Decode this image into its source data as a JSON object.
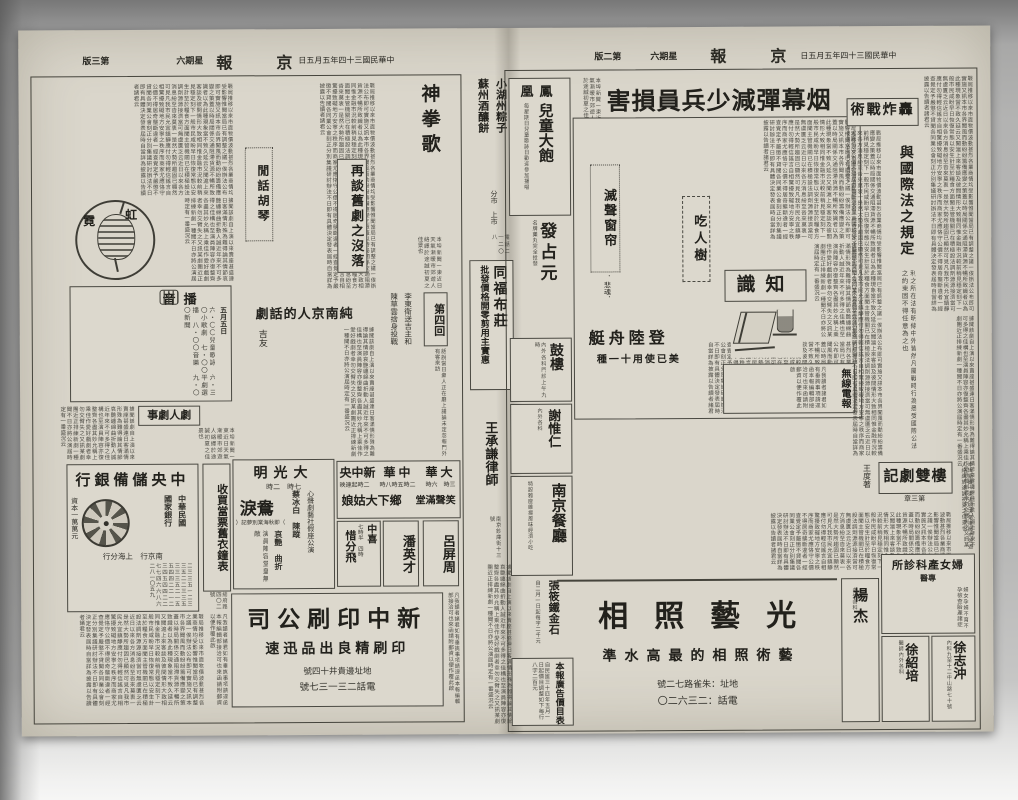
{
  "masthead": {
    "title": "京　報",
    "date": "中華民國三十四年五月五日",
    "weekday": "星期六",
    "edition_right": "第二版",
    "edition_left": "第三版"
  },
  "page_right": {
    "lead_headline": "烟幕彈減少兵員損害",
    "articles": {
      "bombing": {
        "title": "轟炸戰術",
        "subtitle": "與國際法之規定"
      },
      "silencer": {
        "title": "滅聲窗帘",
        "byline": "．悲魂．"
      },
      "tree": {
        "title": "吃人樹"
      },
      "knowledge": {
        "title": "知識"
      },
      "landing": {
        "title": "登陸舟艇",
        "subtitle": "美已使用十一種"
      },
      "wireless": {
        "title": "無線電報"
      },
      "serial": {
        "title": "瓊樓雙劇記",
        "author": "王度著",
        "chapter": "第三章"
      }
    },
    "ads": {
      "phoenix": {
        "title": "鳳凰",
        "big": "兒童大飽",
        "note": "每星期日兒童歌詠日歡迎參加播唱"
      },
      "fazhanyuan": {
        "title": "發占元",
        "note": "名牌藥丸完全批發"
      },
      "gulou": {
        "title": "鼓樓",
        "note": "內外各科門診上午九時"
      },
      "xieweiren": {
        "title": "謝惟仁",
        "note": "內外各科"
      },
      "lawyer": {
        "title": "王承謙律師",
        "note": "南京鈔庫街十三號"
      },
      "restaurant": {
        "title": "南京餐廳",
        "note": "特設雅座維揚風味經濟小吃"
      },
      "seal": {
        "title": "張筱鐵金石",
        "note": "自二月一日起每字二千元"
      },
      "pricelist": {
        "title": "本報廣告價目表",
        "note": "自民國三十四年五月一日起價目調整如下每行八字二百元"
      },
      "photo": {
        "title": "光藝照相",
        "subtitle": "藝術照相的最高水準",
        "address": "地址：朱雀路七二號",
        "phone": "電話：二三六二〇"
      },
      "yangjie": {
        "title": "楊杰",
        "note": "內外各科"
      },
      "clinic": {
        "title": "婦女產科診所",
        "sub": "專醫",
        "note": "婦女孕婦不育不孕檢查胎產諸症"
      },
      "xuzhichong": {
        "title": "徐志沖",
        "note": "內科九至十二中山路七十號"
      },
      "xushaopei": {
        "title": "徐紹培",
        "note": "醫師內外各科"
      }
    }
  },
  "gutter_ads": {
    "zongzi": {
      "line1": "小湖州粽子",
      "line2": "蘇州酒釀餅",
      "note": "分市　上市",
      "phone": "電話二一二〇八"
    },
    "tongfu": {
      "title": "同福布莊",
      "lines": "批發價格開零剪用主實惠"
    }
  },
  "page_left": {
    "articles": {
      "huqin": {
        "title": "閒話胡琴"
      },
      "opera": {
        "title": "再談舊劇之沒落"
      },
      "songfist": {
        "title": "神拳歌"
      },
      "drama": {
        "title": "純南京人的話劇",
        "byline": "吉友"
      },
      "gossip": {
        "title": "劇人劇事"
      },
      "serial": {
        "chapter": "第四回",
        "c1": "李東衛送吉主和",
        "c2": "陳草雲捨身投戰"
      },
      "rainbow": {
        "char1": "虹",
        "char2": "霓"
      },
      "broadcast": {
        "title": "播音",
        "date": "五月五日",
        "items_text": "六・〇〇兒童歌詠　六・三〇小歌劇　七・〇〇平劇選播　八・〇〇音樂　九・〇〇新聞"
      }
    },
    "ads": {
      "bank": {
        "title": "中央儲備銀行",
        "line1": "中華民國",
        "line2": "國家銀行",
        "capital": "資本一萬萬元",
        "branches": "南京行　上海分行"
      },
      "pawn": {
        "title": "收買當票舊衣鐘表",
        "note": "總府路四〇二號"
      },
      "daguangming": {
        "title": "大光明",
        "times": "七時　二時",
        "troupe": "心聲劇藝社假座公演",
        "names": "蔡冰白　陳蹤",
        "film": "鴛鴦淚",
        "alt": "（即秋海棠別夢記）",
        "tags": "哀艷　曲折",
        "cast": "演員陣容堂皇無敵"
      },
      "cinemas": {
        "h1_name": "大華",
        "h1_times": "三時　六時",
        "h2_name": "中華",
        "h2_times": "二時五時八時",
        "h3_name": "新中央",
        "h3_times": "二時起連映",
        "tag": "笑聲滿堂",
        "film": "鄉下大姑娘"
      },
      "lvpingzhou": {
        "title": "呂屏周"
      },
      "panyingcai": {
        "title": "潘英才"
      },
      "zhongxi": {
        "title": "中喜",
        "film": "惜分飛",
        "times": "七時半　四時"
      },
      "press": {
        "title": "新中印刷公司",
        "subtitle": "印刷精良出品迅速",
        "address": "地址邊貴井十四號",
        "phone": "電話二三一三七號"
      }
    }
  },
  "filler": {
    "a": "戰局推移以來市面物價波動甚烈各業商情均受影響惟聞當局已有調整之議一俟辦法公布即可實施又訊本市各界聞風而動紛紛籌備應變之策蓋以時局關係交通阻滯貨源不暢所致識者以為此種現象當不致久延云又聞滬上來客談及彼間情形大致相同惟金融市況較前稍見穩定刻下一般市民咸盼早日恢復常態以安生計至於糧食方面聞主管機關已在積極設法調劑源源接濟當可無虞匱乏云近日以來各方消息紛至沓來莫衷一是然大勢所趨固已顯然可見凡我市民允宜鎮靜應付勿得輕信謠言自相驚擾致礙地方安寧之秩序而商家尤應恪守公價不得居奇壟斷違者一經查覺定予嚴懲不貸聞各同業公會刻正分別集議研討辦法不日即有具體決定發表屆時自當詳為披露以告讀者諸君云",
    "b": "據聞該劇自上演以來賣座甚盛連日客滿情形殊為難得論其情節哀艷纏綿曲折動人誠近年來不可多得之佳構也至演員陣容亦復整齊各盡其妙允稱上乘佳作愛好戲劇者幸勿交臂失之又訊某劇團近正排練新劇一種聞不日亦將公演屆時定有一番盛況云",
    "c": "本埠新聞一束近日天氣漸暖市郊遊人絡繹於途誠初夏之佳景也",
    "d": "凡我讀者諸君如有垂詢事項請逕函本報編輯部接洽可也來函請附郵資以便作覆此啟",
    "digits": "二三三五一二三三五二二三三五三三三五二一五五四四二二一二三四五四四二二七七四六六八六二八一〇五九",
    "spaced": "利之所在法有明條中外皆然凡屬戰時行為悉受國際公法之約束固不得任意為之也",
    "couplet_note": "話說當日衆人正在廳上議論未定忽報門外有客來訪"
  }
}
